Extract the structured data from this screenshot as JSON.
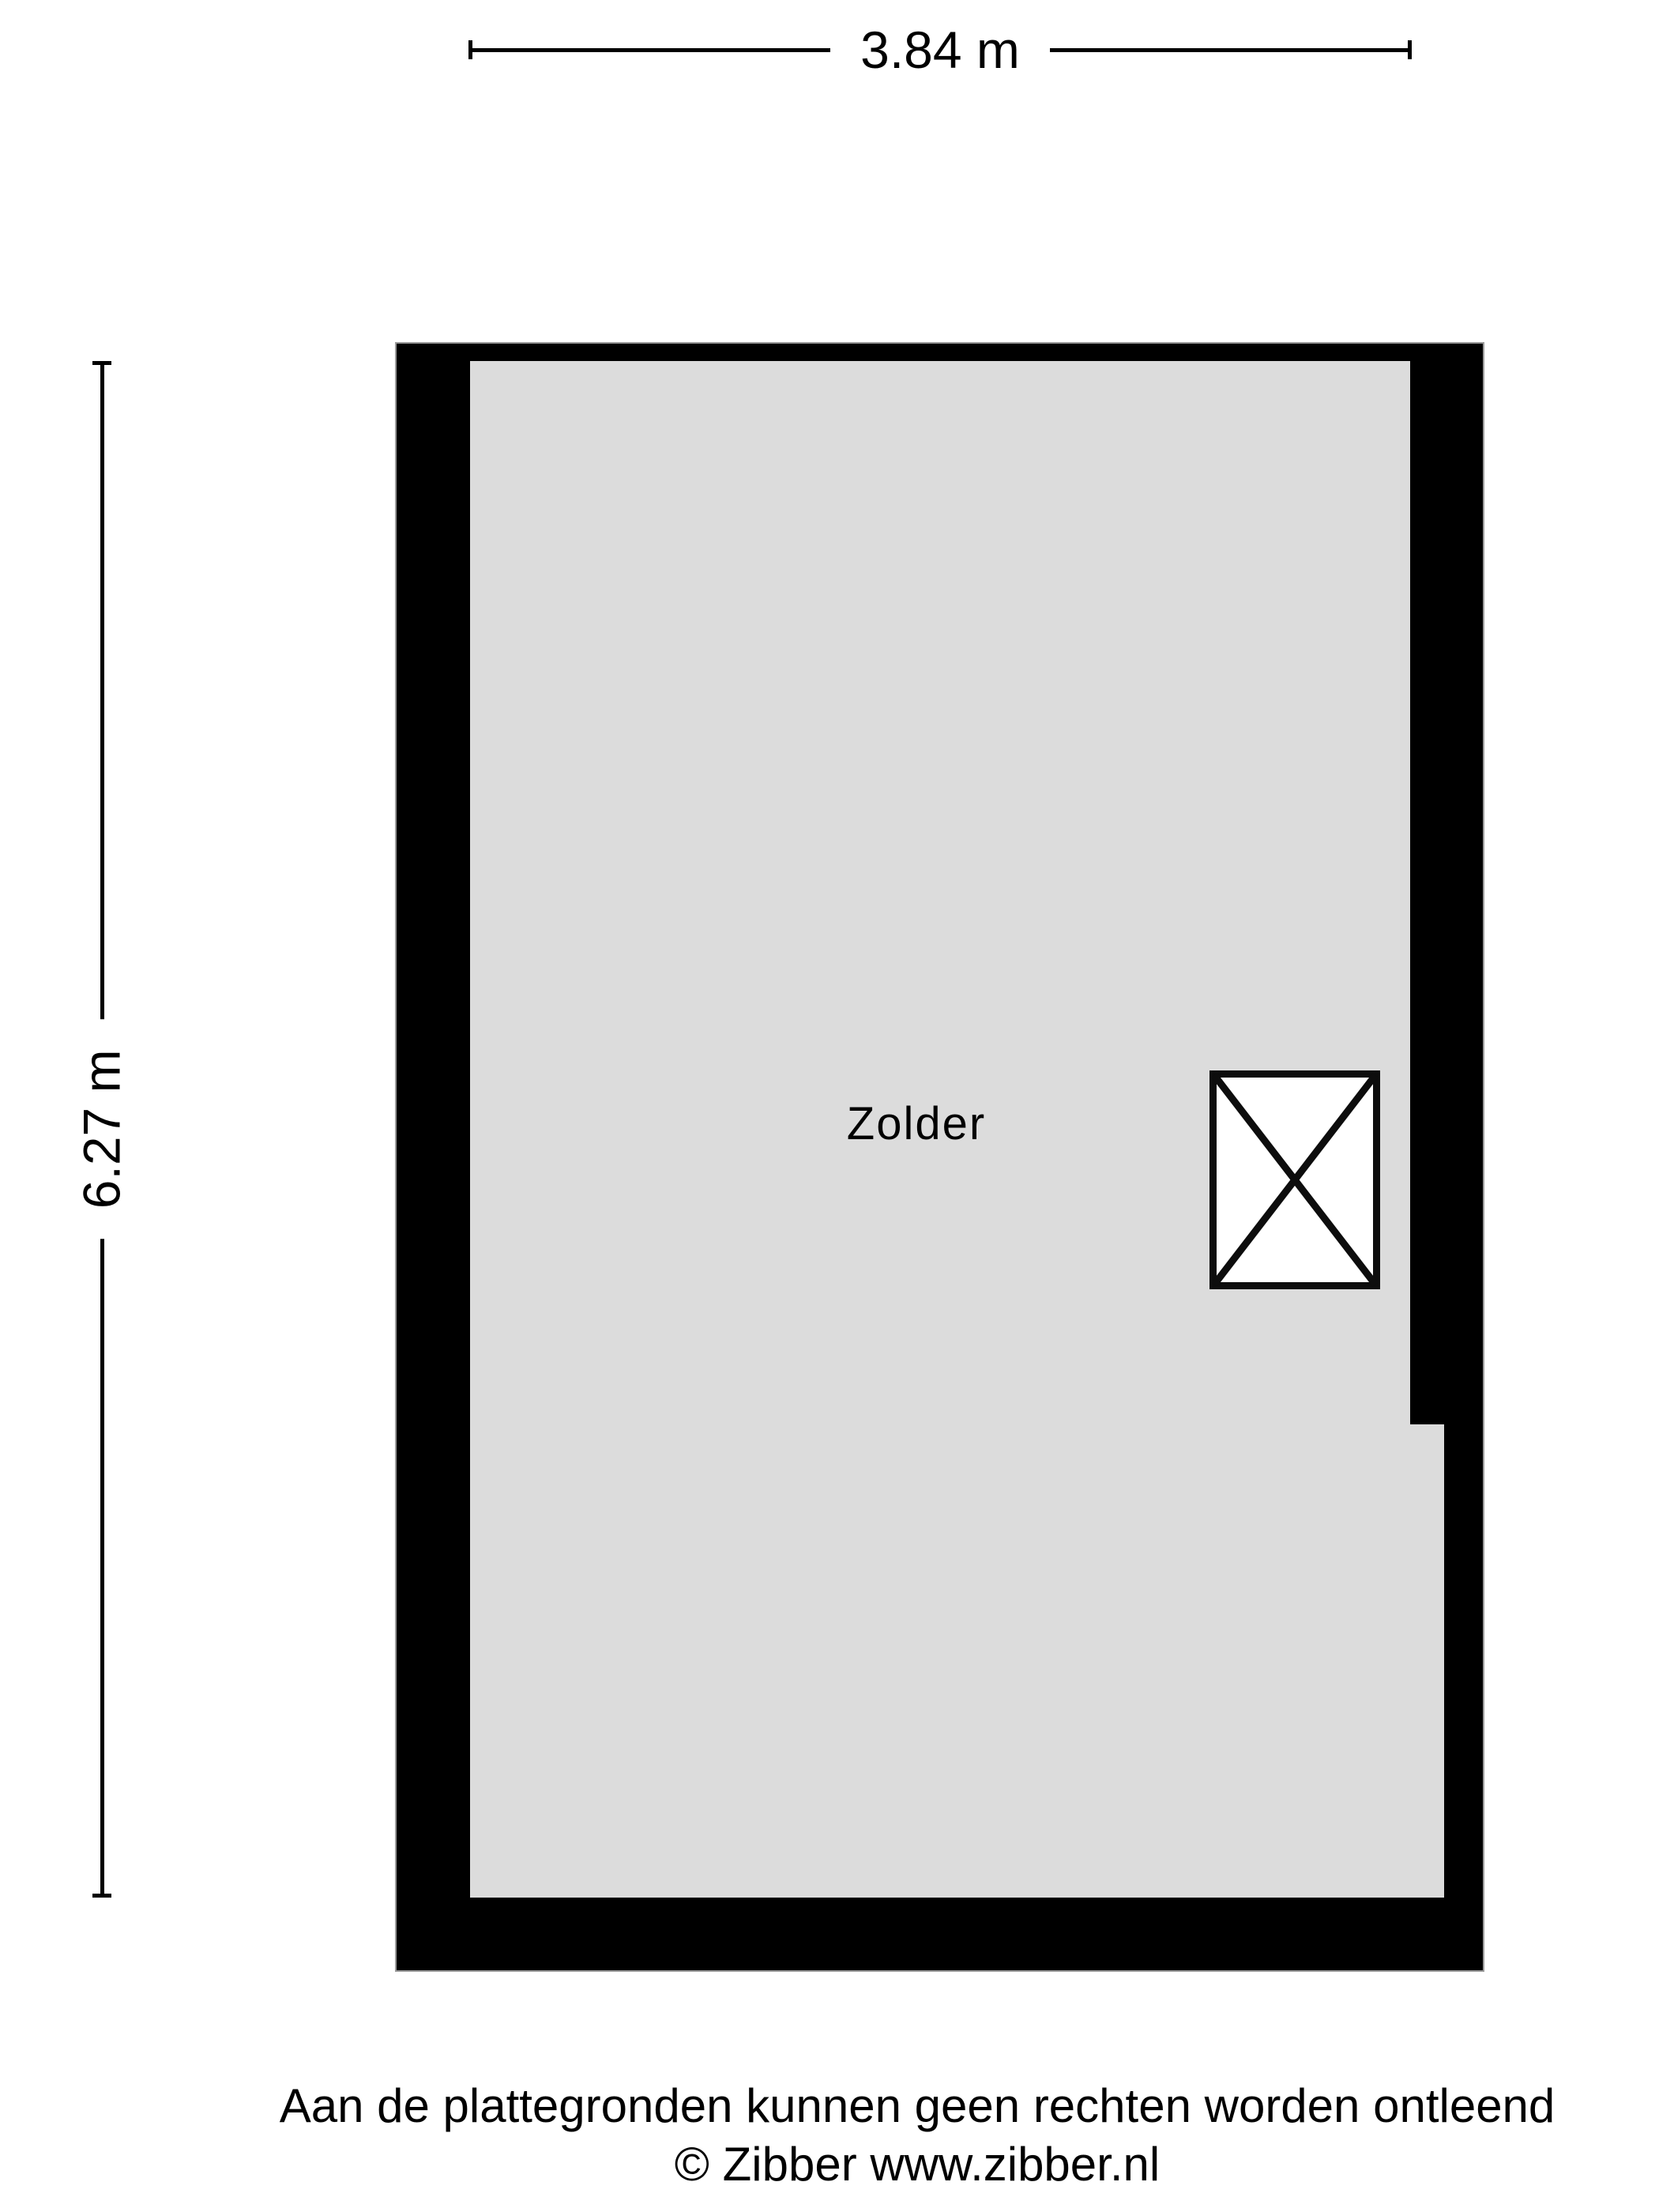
{
  "colors": {
    "page_bg": "#ffffff",
    "wall": "#000000",
    "floor": "#dcdcdc",
    "outline": "#9b9b9b",
    "ink": "#000000"
  },
  "dimensions": {
    "width_label": "3.84 m",
    "height_label": "6.27 m"
  },
  "floorplan": {
    "room_label": "Zolder",
    "stair_symbol": "crossed-rectangle"
  },
  "footer": {
    "disclaimer": "Aan de plattegronden kunnen geen rechten worden ontleend",
    "copyright": "© Zibber www.zibber.nl"
  }
}
